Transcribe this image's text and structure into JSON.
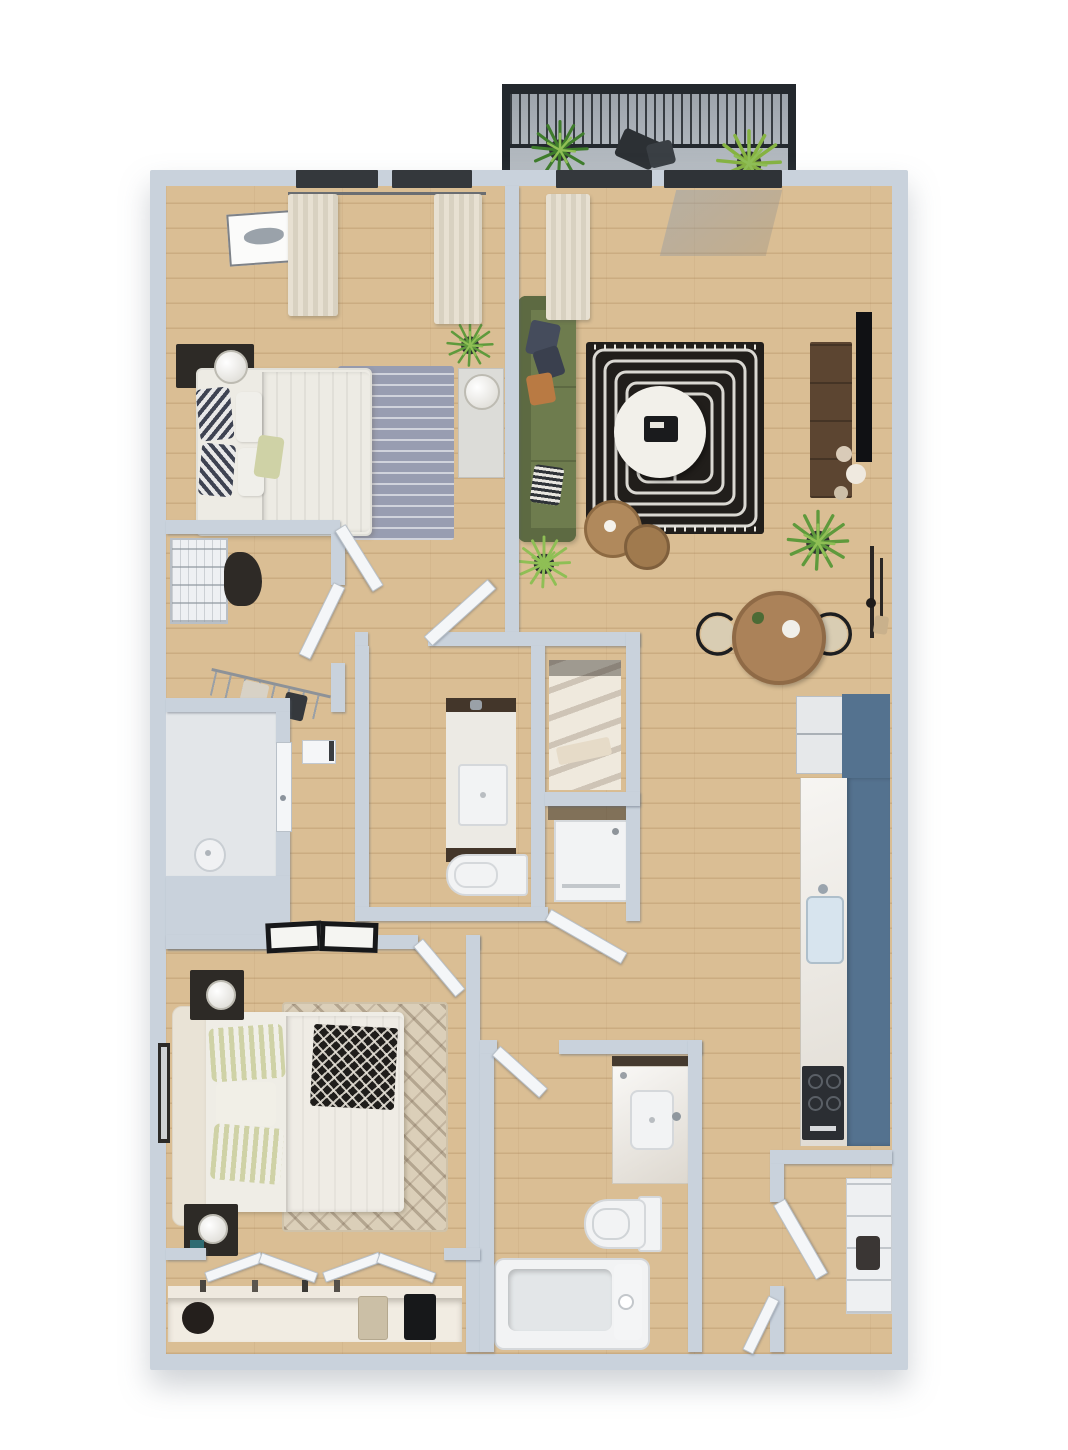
{
  "scene": {
    "kind": "3d-rendered-floor-plan",
    "view": "top-down isometric",
    "unit_type": "two-bedroom two-bath apartment",
    "visible_text": ""
  },
  "palette": {
    "wall": "#c9d2dc",
    "wallShadow": "rgba(90,102,118,.45)",
    "floorWood": "#dabe94",
    "floorLine": "rgba(150,108,62,.22)",
    "utilityFloor": "#e3e6e9",
    "balconyA": "#99a0a8",
    "balconyB": "#bac0c6",
    "railing": "#23282d",
    "door": "#f4f6f8",
    "sofa": "#6e7c4e",
    "sofaDark": "#5d6a42",
    "rugLiving": "#211e1b",
    "rugLivingLine": "#eae8e2",
    "rugBed1": "#989db1",
    "rugBed2": "#dbcfb9",
    "table": "#f2f0ea",
    "diningWood": "#ab8259",
    "sideWood": "#b0895c",
    "tv": "#101114",
    "console": "#5c4531",
    "kBlue": "#54728f",
    "counter": "#eae6df",
    "sink": "#d7e4ee",
    "stove": "#2b2e33",
    "fixture": "#f2f3f4",
    "fixEdge": "#d5d8db",
    "vanityWood": "#43362a",
    "bedding": "#edebe4",
    "pillowNavy": "#454c5c",
    "pillowOrange": "#b97a43",
    "stripeGreen": "#cfd2a6",
    "throw": "#1f1d1b",
    "headboard": "#e9e3d6",
    "nightstand": "#2d2a26",
    "lamp": "#f2f2ef",
    "plant": "#5f9a3c",
    "plantLight": "#8fbf55",
    "pot": "#2d3032",
    "wire": "#eef0f3",
    "clothesDark": "#2e2a26",
    "garmentTan": "#cbbfa6",
    "shelfWhite": "#f1ece2",
    "hat": "#241f1c",
    "windowFrame": "#34383c",
    "curtain": "#e7e0d2",
    "curtainDark": "#d8d1c1"
  },
  "rooms": [
    {
      "name": "balcony",
      "items": [
        "railing",
        "potted-plant",
        "potted-plant",
        "lounge-chair"
      ]
    },
    {
      "name": "bedroom-1",
      "items": [
        "windows-with-curtains",
        "wall-art",
        "nightstand-with-lamp",
        "queen-bed",
        "area-rug",
        "dresser-with-lamp",
        "potted-plant"
      ]
    },
    {
      "name": "walk-in-closet",
      "items": [
        "wire-basket-unit",
        "folded-clothes",
        "hanging-rod-with-clothes"
      ]
    },
    {
      "name": "living-room",
      "items": [
        "balcony-slider",
        "window-with-curtain",
        "green-sofa",
        "throw-pillows",
        "patterned-rug",
        "round-coffee-table",
        "side-tables",
        "tv-console",
        "wall-tv",
        "decor-spheres",
        "potted-plant",
        "potted-plant",
        "wall-rack"
      ]
    },
    {
      "name": "dining-area",
      "items": [
        "round-table",
        "wicker-chair",
        "wicker-chair"
      ]
    },
    {
      "name": "kitchen",
      "items": [
        "refrigerator",
        "blue-cabinet-run",
        "counter",
        "sink",
        "range"
      ]
    },
    {
      "name": "bathroom-1",
      "items": [
        "vanity-sink",
        "toilet",
        "linen-closet",
        "washer-dryer-closet"
      ]
    },
    {
      "name": "utility-room",
      "items": [
        "door",
        "floor-drain"
      ]
    },
    {
      "name": "hallway",
      "items": [
        "thermostat-panel",
        "open-doors"
      ]
    },
    {
      "name": "bedroom-2",
      "items": [
        "ceiling-lights",
        "bed-with-headboard",
        "striped-pillows",
        "patterned-throw",
        "area-rug",
        "nightstand-with-lamp",
        "nightstand-with-lamp",
        "wall-art",
        "bifold-closet",
        "closet-shelf",
        "hat",
        "hanging-clothes"
      ]
    },
    {
      "name": "bathroom-2",
      "items": [
        "vanity-sink",
        "toilet",
        "bathtub"
      ]
    },
    {
      "name": "entry-closet",
      "items": [
        "shelf-unit",
        "door"
      ]
    }
  ]
}
